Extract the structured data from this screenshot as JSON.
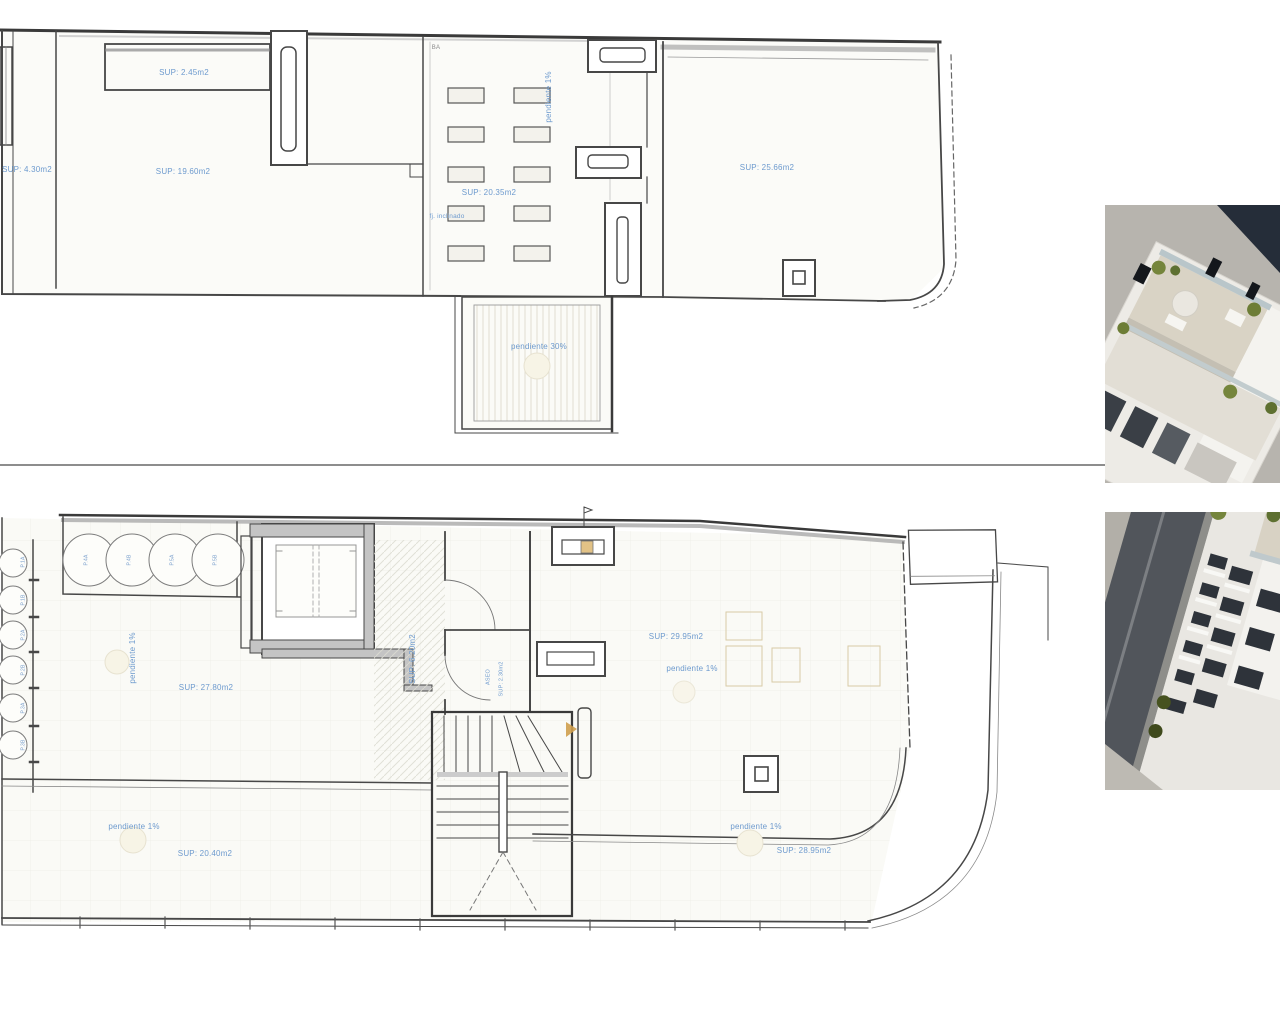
{
  "document": {
    "type": "architectural-floor-plans",
    "divider_color": "#8d8d8d",
    "label_color": "#6d9ace",
    "wall_color": "#474747",
    "plan_fill": "#fbfbf7"
  },
  "roof_plan": {
    "labels": {
      "sup_left_strip": "SUP: 4.30m2",
      "sup_top_room": "SUP: 2.45m2",
      "sup_main_room": "SUP: 19.60m2",
      "sup_center_terrace": "SUP: 20.35m2",
      "pendiente_center": "pendiente 1%",
      "fj_inclinado": "fj. inclinado",
      "sup_right_terrace": "SUP: 25.66m2",
      "pendiente_roof": "pendiente 30%",
      "ref_mark": "BA"
    }
  },
  "floor_plan": {
    "labels": {
      "pendiente_left": "pendiente 1%",
      "sup_left_terrace": "SUP: 27.80m2",
      "sup_hall": "SUP: 6.20m2",
      "aseo": "ASEO",
      "sup_aseo": "SUP: 2.30m2",
      "sup_right_terrace": "SUP: 29.95m2",
      "pendiente_right": "pendiente 1%",
      "pendiente_bottom_left": "pendiente 1%",
      "sup_bottom_left": "SUP: 20.40m2",
      "pendiente_bottom_right": "pendiente 1%",
      "sup_bottom_right": "SUP: 28.95m2"
    },
    "ac_top": [
      "P.4A",
      "P.4B",
      "P.5A",
      "P.5B"
    ],
    "ac_left": [
      "P.1A",
      "P.1B",
      "P.2A",
      "P.2B",
      "P.3A",
      "P.3B"
    ]
  }
}
